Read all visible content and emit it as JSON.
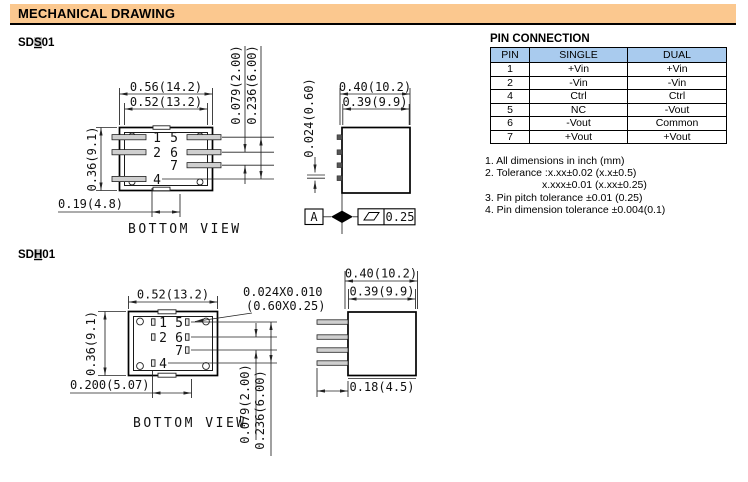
{
  "header": {
    "title": "MECHANICAL DRAWING"
  },
  "models": {
    "sds01": {
      "prefix": "SD",
      "key": "S",
      "suffix": "01"
    },
    "sdh01": {
      "prefix": "SD",
      "key": "H",
      "suffix": "01"
    }
  },
  "pin_labels": {
    "p1": "1",
    "p2": "2",
    "p4": "4",
    "p5": "5",
    "p6": "6",
    "p7": "7"
  },
  "sds01": {
    "caption": "BOTTOM VIEW",
    "dims": {
      "width_outer": "0.56(14.2)",
      "width_inner": "0.52(13.2)",
      "height": "0.36(9.1)",
      "pin_length": "0.19(4.8)",
      "pin_pitch": "0.079(2.00)",
      "pin_span": "0.236(6.00)",
      "side_width_outer": "0.40(10.2)",
      "side_width_inner": "0.39(9.9)",
      "pin_thickness": "0.024(0.60)",
      "datum": "A",
      "flatness": "0.25"
    }
  },
  "sdh01": {
    "caption": "BOTTOM VIEW",
    "dims": {
      "width": "0.52(13.2)",
      "height": "0.36(9.1)",
      "pin_offset": "0.200(5.07)",
      "pin_pitch": "0.079(2.00)",
      "pin_span": "0.236(6.00)",
      "pad_note_line1": "0.024X0.010",
      "pad_note_line2": "(0.60X0.25)",
      "side_width_outer": "0.40(10.2)",
      "side_width_inner": "0.39(9.9)",
      "pin_length": "0.18(4.5)"
    }
  },
  "pin_table": {
    "title": "PIN CONNECTION",
    "headers": [
      "PIN",
      "SINGLE",
      "DUAL"
    ],
    "rows": [
      [
        "1",
        "+Vin",
        "+Vin"
      ],
      [
        "2",
        "-Vin",
        "-Vin"
      ],
      [
        "4",
        "Ctrl",
        "Ctrl"
      ],
      [
        "5",
        "NC",
        "-Vout"
      ],
      [
        "6",
        "-Vout",
        "Common"
      ],
      [
        "7",
        "+Vout",
        "+Vout"
      ]
    ]
  },
  "notes": [
    "1. All dimensions in inch (mm)",
    "2. Tolerance :x.xx±0.02 (x.x±0.5)",
    "x.xxx±0.01 (x.xx±0.25)",
    "3. Pin pitch tolerance ±0.01 (0.25)",
    "4. Pin dimension tolerance ±0.004(0.1)"
  ],
  "colors": {
    "header_bg": "#FBC88F",
    "table_header_bg": "#A9CBEE",
    "find_highlight": "#C8C8C8"
  }
}
